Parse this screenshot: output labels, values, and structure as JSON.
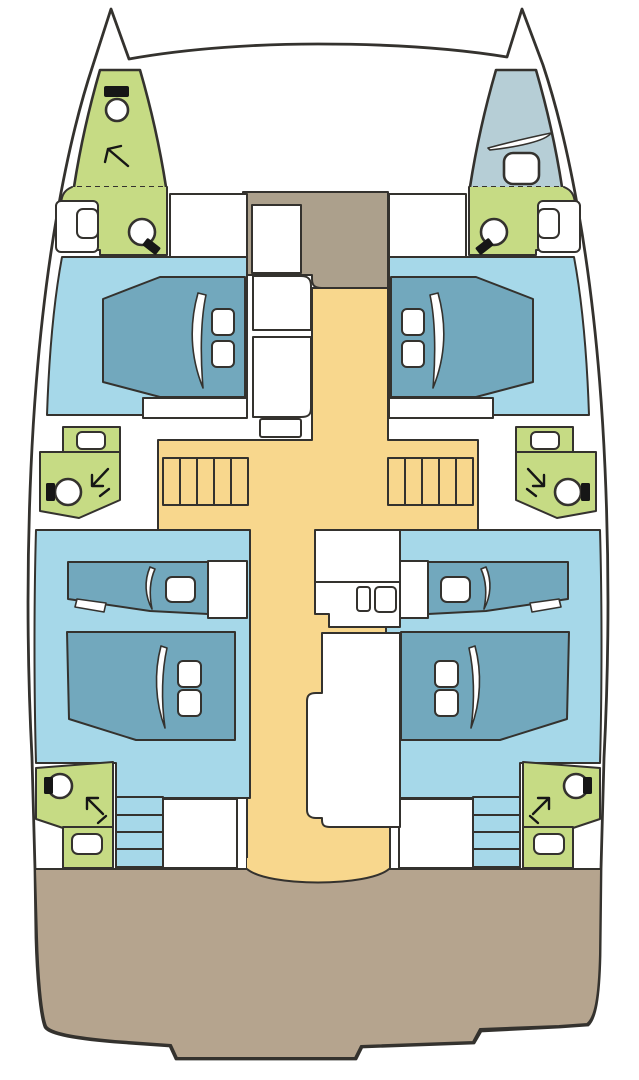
{
  "palette": {
    "outline": "#34322e",
    "hull_white": "#ffffff",
    "cabin_blue": "#a6d8e9",
    "bed_teal": "#72a8bd",
    "bath_green": "#c6db84",
    "walkway_yellow": "#f8d78d",
    "deck_brown": "#b5a48e",
    "foredeck_taupe": "#aca08c",
    "forepeak_blue": "#b6ced6",
    "icon_dark": "#161616"
  },
  "vessel": {
    "view": "deck-plan-top-view",
    "type": "catamaran-4-cabin-layout",
    "port_hull": {
      "forepeak_head": {
        "area": "bath_green",
        "fixtures": [
          "marine-toilet",
          "shower-arrow"
        ]
      },
      "forward_head": {
        "area": "bath_green",
        "fixtures": [
          "sink",
          "marine-toilet"
        ]
      },
      "forward_cabin": {
        "area": "cabin_blue",
        "fixtures": [
          "double-berth",
          "pillow",
          "pillow",
          "wardrobe"
        ]
      },
      "mid_head": {
        "area": "bath_green",
        "fixtures": [
          "sink",
          "marine-toilet",
          "shower-arrow"
        ]
      },
      "companionway_steps": {
        "area": "walkway_yellow",
        "step_count": 5
      },
      "aft_cabin": {
        "area": "cabin_blue",
        "fixtures": [
          "single-berth",
          "pillow",
          "double-berth",
          "pillow",
          "pillow"
        ]
      },
      "aft_head": {
        "area": "bath_green",
        "fixtures": [
          "marine-toilet",
          "shower-arrow",
          "sink"
        ]
      },
      "aft_steps": {
        "area": "cabin_blue",
        "step_count": 4
      }
    },
    "starboard_hull": {
      "forepeak_berth": {
        "area": "forepeak_blue",
        "fixtures": [
          "crew-berth",
          "deck-hatch"
        ]
      },
      "mirrors_port_hull": true
    },
    "centerline": {
      "foredeck_locker": {
        "area": "foredeck_taupe",
        "fixtures": [
          "cabinet"
        ]
      },
      "saloon_walkway": {
        "area": "walkway_yellow"
      },
      "galley_block": {
        "fixtures": [
          "counter",
          "storage-box",
          "sink-basins",
          "island-unit"
        ]
      },
      "trampoline": {
        "area": "hull_white"
      },
      "aft_deck": {
        "area": "deck_brown"
      }
    }
  }
}
